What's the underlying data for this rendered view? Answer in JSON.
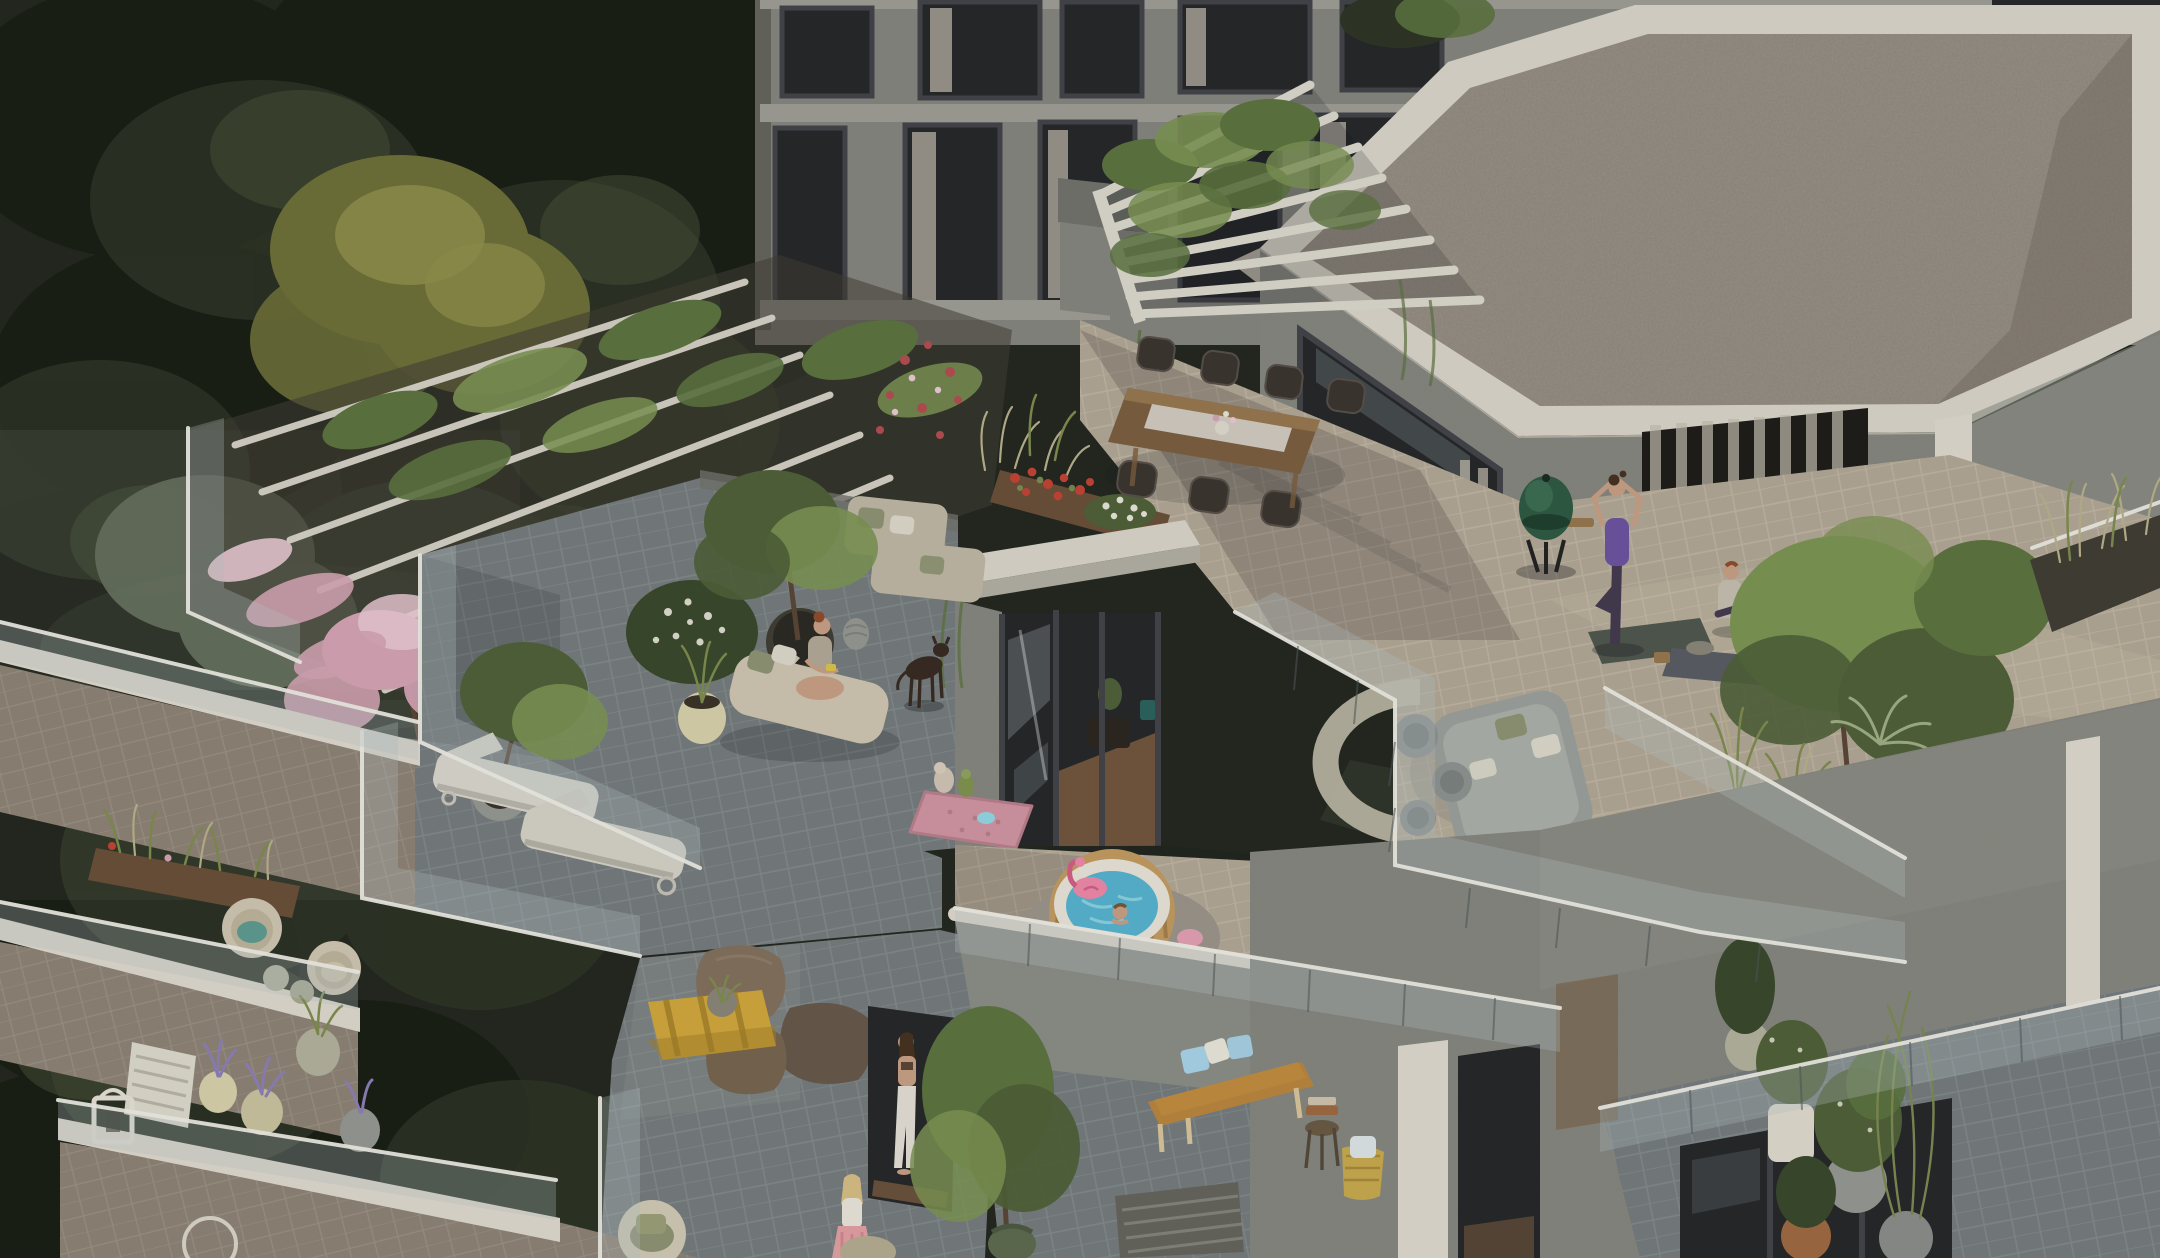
{
  "image": {
    "kind": "architectural-3d-rendering",
    "view": "high-angle aerial",
    "width_px": 2160,
    "height_px": 1258
  },
  "scene": {
    "setting": "Modern terraced apartment building at dusk beside a dense dark forest; stepped penthouse roof terraces richly furnished and planted",
    "areas": {
      "forest": "dense dark green tree canopy filling the left half, one olive-yellow crown, misty lower slope",
      "upper_facade": "grey concrete facade with dark-framed windows and pale curtains",
      "gravel_roof": "flat pebble-gravel roof with white border parapet, top right",
      "pergola": "white slatted pergola overgrown with climbing greenery above the dining terrace",
      "trellis_garden": "rows of white trellis planters with vines, roses and pink cherry blossom on the left terrace",
      "dining_terrace": "beige tiled penthouse terrace with long wooden dining table, table runner, flower vase and seven dark wicker chairs",
      "bbq": "dark green kamado egg grill on black stand",
      "yoga_area": "woman in purple top doing tree pose on grey mat, second seated person on mat with bolster",
      "lounge_pit": "grey wicker sofa with sage and white cushions, three wicker poufs, curved concrete bench ring",
      "penthouse_box": "glass sliding doors in dark frames with interior glimpse of wood floor and furniture",
      "chaise_terrace": "darker grey tiled terrace with cream chaise longue, seated woman, beige modular sofa, potted tree, dark dog, pink quilted pet bed with toys",
      "hot_tub_terrace": "round inflatable hot tub with wood-look sides, white rim, blue water, pink flamingo float, child bathing, star floats on round grey mat",
      "lounger_terrace": "two white wheeled sun loungers and potted tree",
      "beanbag_terrace": "three taupe bean bags and yellow pallet coffee table with plant tray",
      "bench_terrace": "wooden bench with tan cushion, blue and white pillows, side stool with towels, woven basket",
      "left_balconies": "stepped balconies with cream rattan chairs, teal cushion, white slat bench, lavender and rosemary pots, white lantern",
      "bottom_right_tower": "speckled concrete corner with white pilasters, dark windows, glass-railed terrace crowded with potted shrubs",
      "people": [
        "yoga woman in purple",
        "seated yoga partner",
        "red-haired woman on chaise",
        "child in hot tub",
        "woman in white trousers at doorway",
        "blonde woman in pink skirt"
      ],
      "animal": "dark brown dog standing on chaise terrace"
    }
  },
  "palette": {
    "forest_base": "#232820",
    "forest_dark": "#1a1f16",
    "forest_mid": "#2e3526",
    "forest_light": "#47523a",
    "forest_olive": "#6e7038",
    "forest_olive_hi": "#90924c",
    "forest_sage": "#66705a",
    "fog": "#7b8077",
    "facade": "#85857f",
    "facade_dark": "#65655d",
    "facade_slab": "#9d9d96",
    "window_dark": "#25272a",
    "window_frame": "#43444a",
    "curtain": "#c4beb0",
    "roof_white": "#d8d4c9",
    "roof_edge": "#b2aea3",
    "gravel": "#8f877b",
    "gravel_dark": "#564f45",
    "pergola": "#dbd7cc",
    "vine": "#5c7340",
    "vine_hi": "#7c9454",
    "blossom": "#d4a4b4",
    "blossom_hi": "#eac9d4",
    "rose": "#b44d52",
    "geranium": "#c24436",
    "flower_white": "#e6e3d6",
    "tile_beige": "#b2a795",
    "tile_beige_hi": "#c3b9a7",
    "tile_gray": "#757c7d",
    "tile_gray_hi": "#879091",
    "tile_brown": "#8d8274",
    "tile_brown_hi": "#a0968a",
    "fascia": "#ded9cd",
    "concrete": "#8b8d86",
    "concrete_dark": "#70726b",
    "box_wall": "#83857e",
    "glass": "#b5c5c7",
    "rail_white": "#ecebe4",
    "post": "#4f585a",
    "wood": "#7c5e40",
    "wood_hi": "#96764f",
    "runner": "#d8d4cb",
    "wicker": "#3a352f",
    "wicker_hi": "#57504a",
    "grill": "#2e5a43",
    "skin": "#c89f85",
    "purple": "#6d54a0",
    "leggings": "#443a50",
    "hair_dark": "#46321f",
    "hair_blonde": "#d6bd85",
    "hair_red": "#8e4c2c",
    "chaise": "#cec6b1",
    "sofa": "#bfb7a4",
    "cushion_sage": "#8e9374",
    "cushion_white": "#dcd8cb",
    "dog": "#372b22",
    "dogbed": "#d095a2",
    "tub_wood": "#c29a60",
    "tub_wood_dark": "#8c6a3a",
    "tub_rim": "#e8e3d7",
    "water": "#57b3cf",
    "water_hi": "#93d6e4",
    "flamingo": "#ec8aa8",
    "flamingo_dark": "#d25e85",
    "bench_wood": "#b9853f",
    "bench_cushion": "#c08c3e",
    "pillow_blue": "#a9d3e9",
    "bean": "#82705c",
    "bean_dark": "#67584a",
    "pallet": "#d0a73e",
    "pallet_dark": "#a37f28",
    "pot_cream": "#d7d0ab",
    "pot_gray": "#949792",
    "pot_white": "#dedacd",
    "pot_terracotta": "#9e6a43",
    "pot_brass": "#9d8757",
    "pot_dark": "#413e35",
    "pot_sage": "#b2b29c",
    "lavender": "#8d7fb6",
    "grass": "#7e8c4f",
    "grass_pale": "#b8b08c",
    "shrub": "#4f6038",
    "shrub_dark": "#39482c",
    "shadow": "#14171c",
    "sun": "#e8decc",
    "teal": "#2e6b63",
    "teal_soft": "#5e9a90",
    "mat_dark": "#4f574e",
    "interior_wood": "#7a5c40"
  }
}
